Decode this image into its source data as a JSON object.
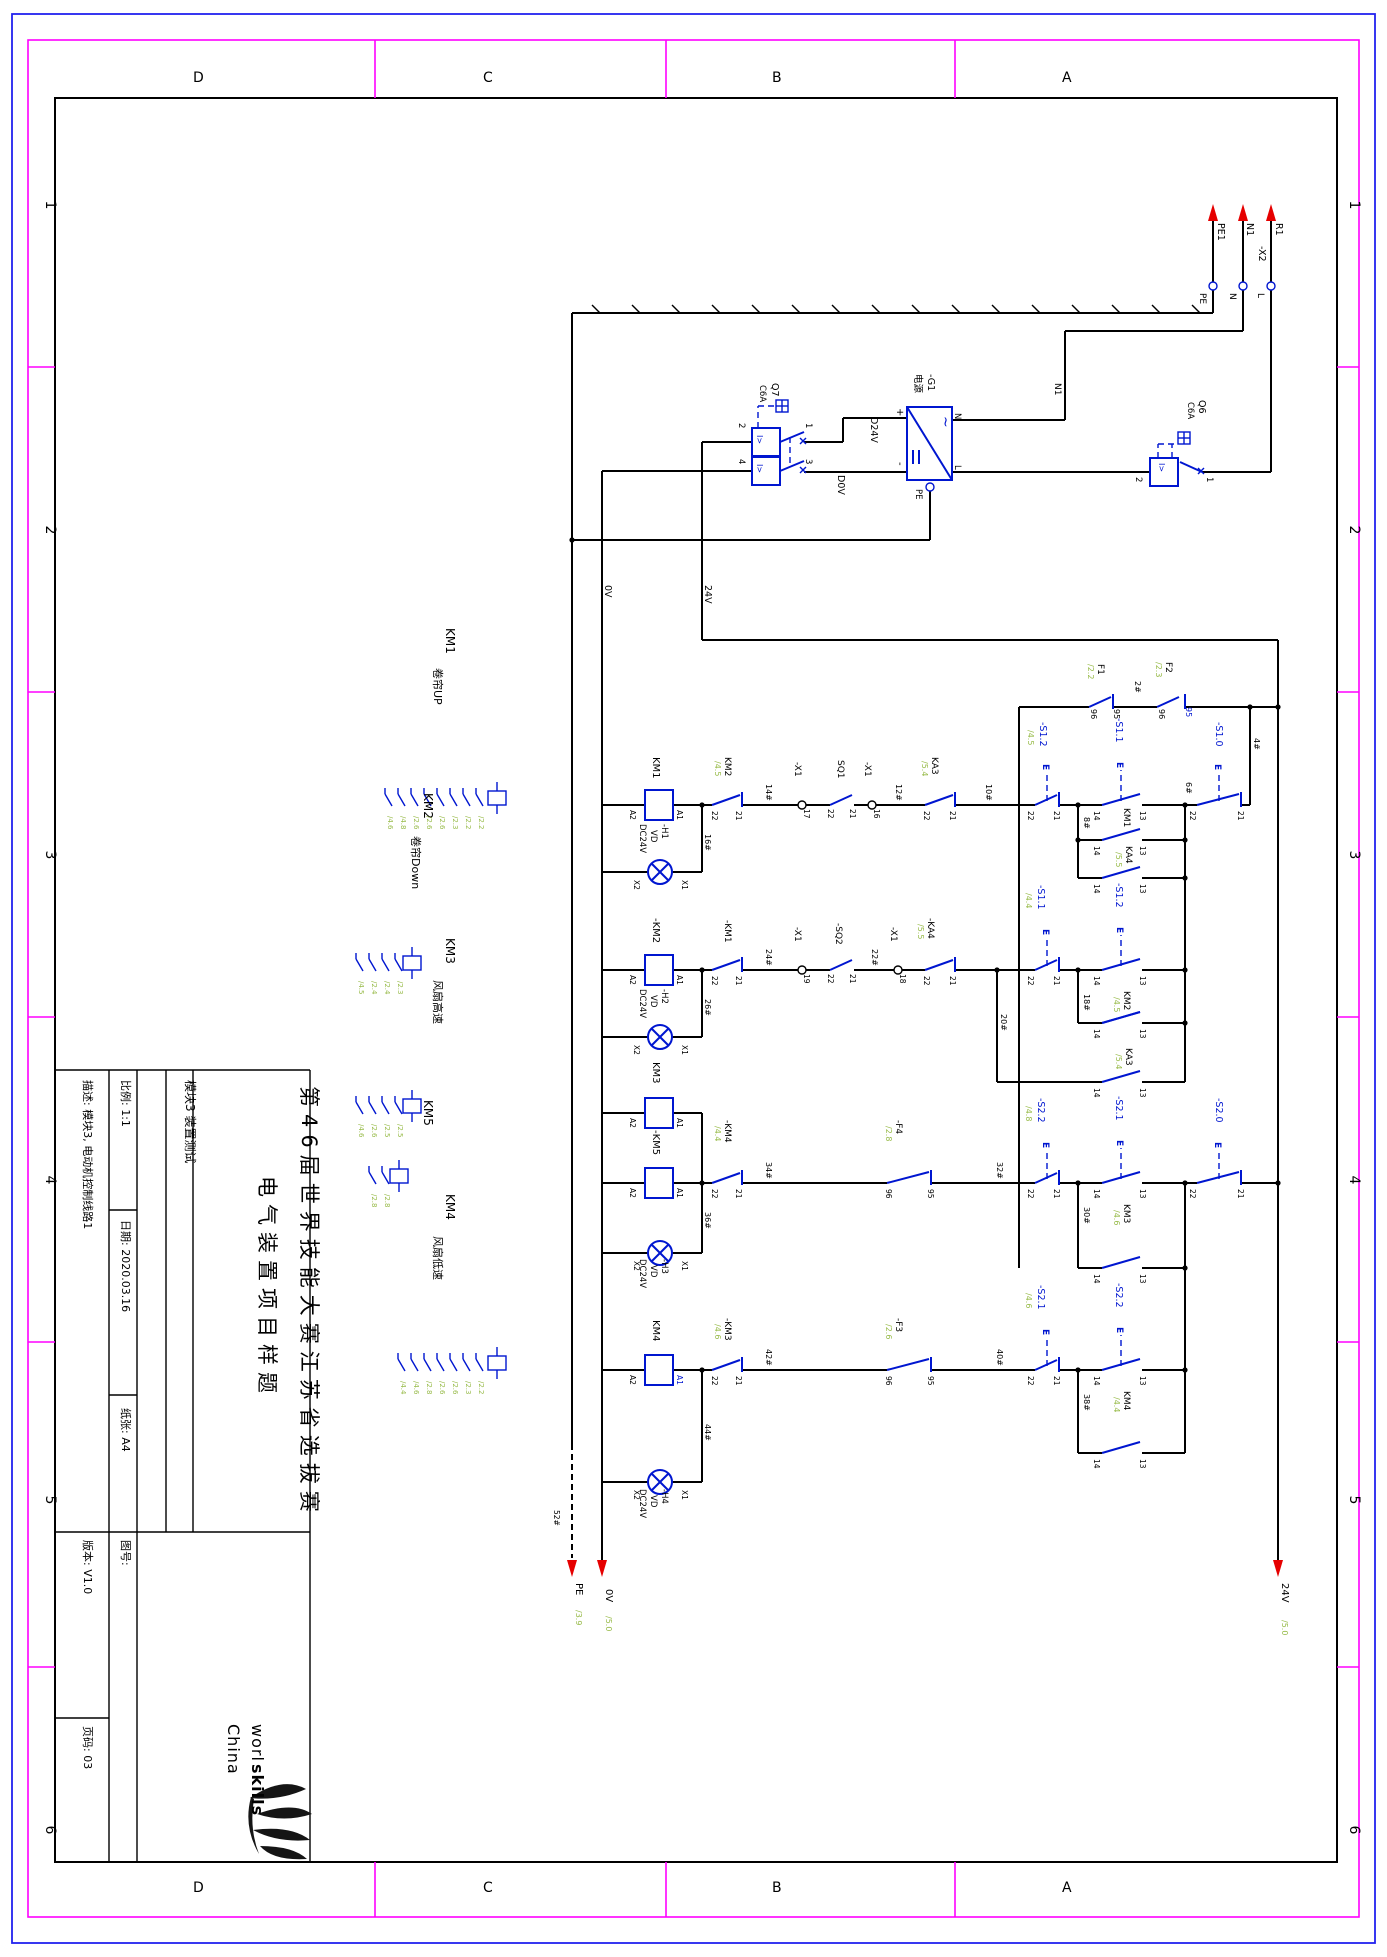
{
  "frame": {
    "cols": [
      "D",
      "C",
      "B",
      "A"
    ],
    "rows": [
      "1",
      "2",
      "3",
      "4",
      "5",
      "6"
    ]
  },
  "tb": {
    "module": "模块3 装置测试",
    "scale": "比例: 1:1",
    "date": "日期: 2020.03.16",
    "paper": "纸张: A4",
    "desc": "描述: 模块3, 电动机控制线路1",
    "title1": "第46届世界技能大赛江苏省选拔赛",
    "title2": "电气装置项目样题",
    "drawing_no": "图号:",
    "version": "版本: V1.0",
    "page": "页码: 03"
  },
  "logo": {
    "word1": "worl",
    "word2": "skills",
    "word3": "China"
  },
  "sym": {
    "e": "E",
    "breaker": "I>",
    "ac": "~"
  },
  "supply": {
    "x2": "-X2",
    "wires": [
      "PE1",
      "N1",
      "R1"
    ],
    "terminals": [
      "PE",
      "N",
      "L"
    ],
    "n1": "N1",
    "rail24": "24V",
    "rail0": "0V",
    "out_plus": "D24V",
    "out_minus": "D0V",
    "q6": {
      "name": "Q6",
      "rating": "C6A",
      "t": [
        "1",
        "2"
      ]
    },
    "q7": {
      "name": "Q7",
      "rating": "C6A",
      "t": [
        "1",
        "2",
        "3",
        "4"
      ]
    },
    "g1": {
      "name": "-G1",
      "desc": "电源",
      "plus": "+",
      "minus": "-",
      "n": "N",
      "l": "L",
      "pe": "PE"
    }
  },
  "prot": {
    "f1": {
      "name": "F1",
      "ref": "/2.2",
      "t": [
        "96",
        "95"
      ]
    },
    "f2": {
      "name": "F2",
      "ref": "/2.3",
      "t": [
        "96",
        "95"
      ]
    },
    "wire2": "2#",
    "wire4": "4#"
  },
  "exits": [
    {
      "label": "PE",
      "ref": "/3.9"
    },
    {
      "label": "0V",
      "ref": "/5.0"
    },
    {
      "label": "24V",
      "ref": "/5.0"
    }
  ],
  "wire_pe": "52#",
  "rungs": [
    {
      "coil": "KM1",
      "a1": "A1",
      "a2": "A2",
      "function": "卷帘UP",
      "lamp": {
        "name": "-H1",
        "type": "VD",
        "volt": "DC24V",
        "x1": "X1",
        "x2": "X2"
      },
      "w_lamp": "16#",
      "wA": "14#",
      "wB": "12#",
      "wC": "10#",
      "w_self": "8#",
      "w_out": "6#",
      "nc1": {
        "name": "KM2",
        "ref": "/4.5",
        "a": "22",
        "b": "21"
      },
      "t1": {
        "name": "-X1",
        "pin": "17"
      },
      "sq": {
        "name": "SQ1",
        "a": "22",
        "b": "21"
      },
      "t2": {
        "name": "-X1",
        "pin": "16"
      },
      "ka": {
        "name": "KA3",
        "ref": "/5.4",
        "a": "22",
        "b": "21"
      },
      "snc": {
        "name": "-S1.2",
        "ref": "/4.5",
        "a": "22",
        "b": "21"
      },
      "sno": {
        "name": "-S1.1",
        "a": "14",
        "b": "13"
      },
      "self": {
        "name": "KM1",
        "a": "14",
        "b": "13"
      },
      "ka2": {
        "name": "KA4",
        "ref": "/5.5",
        "a": "14",
        "b": "13"
      },
      "stop": {
        "name": "-S1.0",
        "a": "22",
        "b": "21"
      }
    },
    {
      "coil": "-KM2",
      "a1": "A1",
      "a2": "A2",
      "function": "卷帘Down",
      "lamp": {
        "name": "-H2",
        "type": "VD",
        "volt": "DC24V",
        "x1": "X1",
        "x2": "X2"
      },
      "w_lamp": "26#",
      "wA": "24#",
      "wB": "22#",
      "wC": "20#",
      "w_self": "18#",
      "nc1": {
        "name": "-KM1",
        "a": "22",
        "b": "21"
      },
      "t1": {
        "name": "-X1",
        "pin": "19"
      },
      "sq": {
        "name": "-SQ2",
        "a": "22",
        "b": "21"
      },
      "t2": {
        "name": "-X1",
        "pin": "18"
      },
      "ka": {
        "name": "-KA4",
        "ref": "/5.5",
        "a": "22",
        "b": "21"
      },
      "snc": {
        "name": "-S1.1",
        "ref": "/4.4",
        "a": "22",
        "b": "21"
      },
      "sno": {
        "name": "-S1.2",
        "a": "14",
        "b": "13"
      },
      "self": {
        "name": "KM2",
        "ref": "/4.5",
        "a": "14",
        "b": "13"
      },
      "ka2": {
        "name": "KA3",
        "ref": "/5.4",
        "a": "14",
        "b": "13"
      }
    },
    {
      "coil": "KM3",
      "coil2": "-KM5",
      "a1": "A1",
      "a2": "A2",
      "function": "风扇高速",
      "lamp": {
        "name": "-H3",
        "type": "VD",
        "volt": "DC24V",
        "x1": "X1",
        "x2": "X2"
      },
      "w_lamp": "36#",
      "wA": "34#",
      "wB": "32#",
      "w_self": "30#",
      "nc1": {
        "name": "-KM4",
        "ref": "/4.4",
        "a": "22",
        "b": "21"
      },
      "f": {
        "name": "-F4",
        "ref": "/2.8",
        "a": "96",
        "b": "95"
      },
      "snc": {
        "name": "-S2.2",
        "ref": "/4.8",
        "a": "22",
        "b": "21"
      },
      "sno": {
        "name": "-S2.1",
        "a": "14",
        "b": "13"
      },
      "self": {
        "name": "KM3",
        "ref": "/4.6",
        "a": "14",
        "b": "13"
      },
      "stop": {
        "name": "-S2.0",
        "a": "22",
        "b": "21"
      }
    },
    {
      "coil": "KM4",
      "a1": "A1",
      "a2": "A2",
      "function": "风扇低速",
      "lamp": {
        "name": "-H4",
        "type": "VD",
        "volt": "DC24V",
        "x1": "X1",
        "x2": "X2"
      },
      "w_lamp": "44#",
      "wA": "42#",
      "wB": "40#",
      "w_self": "38#",
      "nc1": {
        "name": "-KM3",
        "ref": "/4.6",
        "a": "22",
        "b": "21"
      },
      "f": {
        "name": "-F3",
        "ref": "/2.6",
        "a": "96",
        "b": "95"
      },
      "snc": {
        "name": "-S2.1",
        "ref": "/4.6",
        "a": "22",
        "b": "21"
      },
      "sno": {
        "name": "-S2.2",
        "a": "14",
        "b": "13"
      },
      "self": {
        "name": "KM4",
        "ref": "/4.4",
        "a": "14",
        "b": "13"
      }
    }
  ],
  "mirrors": [
    {
      "name": "KM1",
      "refs": [
        "/4.6",
        "/4.8",
        "/2.6",
        "/2.6",
        "/2.6",
        "/2.3",
        "/2.2",
        "/2.2"
      ]
    },
    {
      "name": "KM2",
      "refs": [
        "/4.5",
        "/2.4",
        "/2.4",
        "/2.3"
      ]
    },
    {
      "name": "KM3",
      "refs": [
        "/4.6",
        "/2.6",
        "/2.5",
        "/2.5"
      ]
    },
    {
      "name": "KM5",
      "refs": [
        "/2.8",
        "/2.8"
      ]
    },
    {
      "name": "KM4",
      "refs": [
        "/4.4",
        "/4.6",
        "/2.8",
        "/2.6",
        "/2.6",
        "/2.3",
        "/2.2"
      ]
    }
  ]
}
